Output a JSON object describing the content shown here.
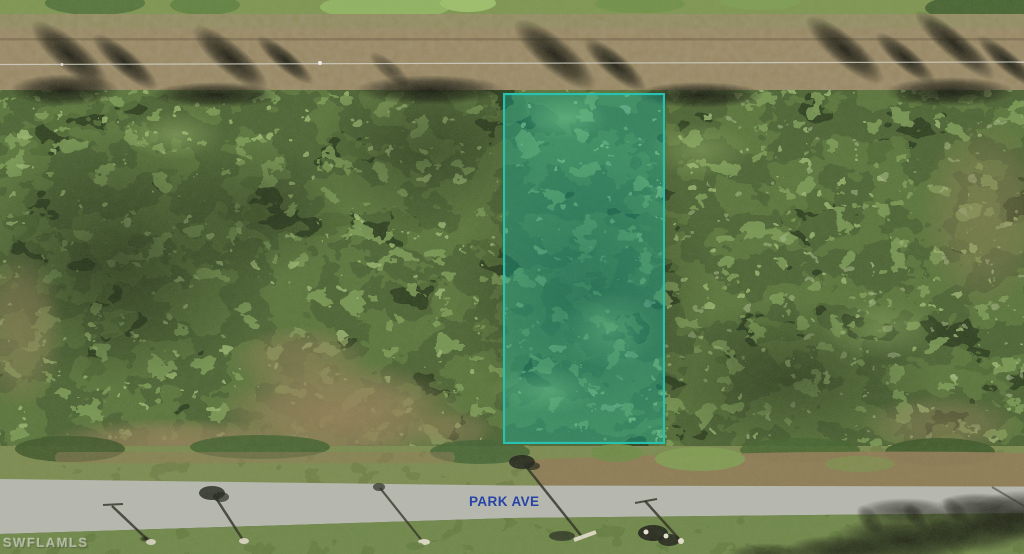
{
  "photo": {
    "street_label": "PARK AVE",
    "street_label_color": "#2743a6",
    "watermark": "SWFLAMLS",
    "parcel_overlay": {
      "outline_color": "#29c2b1",
      "fill_tint": "rgba(10,196,180,0.32)"
    }
  }
}
